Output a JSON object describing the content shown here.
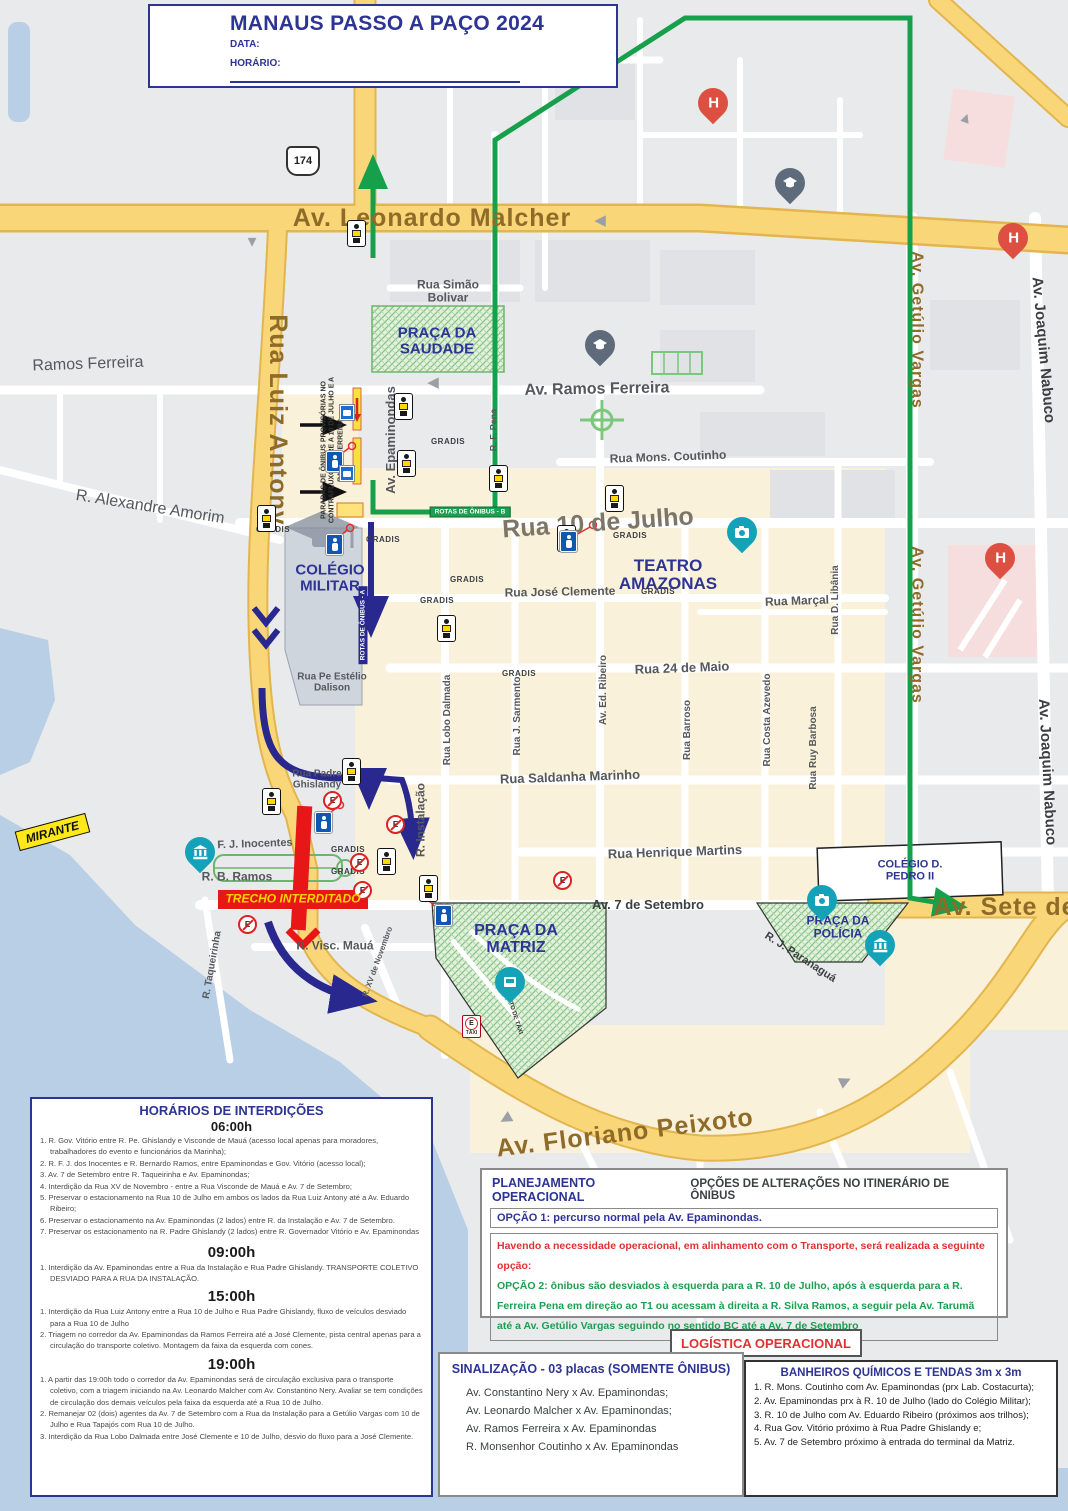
{
  "title_box": {
    "title": "MANAUS PASSO A PAÇO 2024",
    "data_label": "DATA:",
    "horario_label": "HORÁRIO:"
  },
  "map": {
    "labels": {
      "leonardo_malcher": "Av. Leonardo Malcher",
      "simao_bolivar": "Rua Simão Bolivar",
      "praca_saudade": "PRAÇA DA SAUDADE",
      "ramos_ferreira_left": "Ramos Ferreira",
      "av_ramos_ferreira": "Av. Ramos Ferreira",
      "mons_coutinho": "Rua Mons. Coutinho",
      "alexandre_amorim": "R. Alexandre Amorim",
      "rua_luiz_antony": "Rua Luiz Antony",
      "av_epaminondas": "Av. Epaminondas",
      "rua_10_julho": "Rua 10 de Julho",
      "teatro_amazonas": "TEATRO AMAZONAS",
      "jose_clemente": "Rua José Clemente",
      "rua_marcal": "Rua Marçal",
      "rua_d_libania": "Rua D. Libânia",
      "getulio_vargas": "Av. Getúlio Vargas",
      "joaquim_nabuco": "Av. Joaquim Nabuco",
      "rua_24_maio": "Rua 24 de Maio",
      "av_ed_ribeiro": "Av. Ed. Ribeiro",
      "rua_j_sarmento": "Rua J. Sarmento",
      "rua_lobo_dalmada": "Rua Lobo Dalmada",
      "rua_barroso": "Rua Barroso",
      "rua_costa_azevedo": "Rua Costa Azevedo",
      "rua_ruy_barbosa": "Rua Ruy Barbosa",
      "saldanha_marinho": "Rua Saldanha Marinho",
      "pe_estelio": "Rua Pe Estélio Dalison",
      "padre_ghislandy": "Rua Padre Ghislandy",
      "r_instalacao": "R. Instalação",
      "r_f_pena": "R. F. Pena",
      "rf_j_inocentes": "R. F. J. Inocentes",
      "r_b_ramos": "R. B. Ramos",
      "trecho_interditado": "TRECHO INTERDITADO",
      "r_visc_maua": "R. Visc. Mauá",
      "r_taqueirinha": "R. Taqueirinha",
      "r_xv_novembro": "R. XV de Novembro",
      "henrique_martins": "Rua Henrique Martins",
      "av_7_setembro": "Av. 7 de Setembro",
      "colegio_pedro": "COLÉGIO D. PEDRO II",
      "praca_matriz": "PRAÇA DA MATRIZ",
      "praca_policia": "PRAÇA DA POLÍCIA",
      "r_j_paranagua": "R. J. Paranaguá",
      "av_sete_de": "Av. Sete de",
      "floriano_peixoto": "Av. Floriano Peixoto",
      "mirante": "MIRANTE",
      "colegio_militar": "COLÉGIO MILITAR",
      "shield": "174",
      "gradis": "GRADIS",
      "rotas_onibus_a": "ROTAS DE ÔNIBUS - A",
      "rotas_onibus_b": "ROTAS DE ÔNIBUS - B",
      "paradas_note": "PARADAS DE ÔNIBUS PROVISÓRIAS NO CONTRAFLUXO ENTRE A 10 DE JULHO E A RAMOS FERREIRA",
      "ponto_taxi": "PONTO DE TÁXI",
      "e_letter": "E",
      "taxi": "TÁXI",
      "h_letter": "H"
    }
  },
  "horarios": {
    "title": "HORÁRIOS DE INTERDIÇÕES",
    "sections": [
      {
        "time": "06:00h",
        "items": [
          "1. R. Gov. Vitório entre R. Pe. Ghislandy e Visconde de Mauá (acesso local apenas para moradores, trabalhadores do evento e funcionários da Marinha);",
          "2. R. F. J. dos Inocentes e R. Bernardo Ramos, entre Epaminondas e Gov. Vitório (acesso local);",
          "3. Av. 7 de Setembro entre R. Taqueirinha e Av. Epaminondas;",
          "4. Interdição da Rua XV de Novembro - entre a Rua Visconde de Mauá e Av. 7 de Setembro;",
          "5. Preservar o estacionamento na Rua 10 de Julho em ambos os lados da Rua Luiz Antony até a Av. Eduardo Ribeiro;",
          "6. Preservar o estacionamento na Av. Epaminondas (2 lados) entre R. da Instalação e Av. 7 de Setembro.",
          "7. Preservar os estacionamento na R. Padre Ghislandy (2 lados) entre R. Governador Vitório e Av. Epaminondas"
        ]
      },
      {
        "time": "09:00h",
        "items": [
          "1. Interdição da Av. Epaminondas entre a Rua da Instalação e Rua Padre Ghislandy. TRANSPORTE COLETIVO DESVIADO PARA A RUA DA INSTALAÇÃO."
        ]
      },
      {
        "time": "15:00h",
        "items": [
          "1. Interdição da Rua Luiz Antony entre a Rua 10 de Julho e Rua Padre Ghislandy, fluxo de veículos desviado para a Rua 10 de Julho",
          "2. Triagem no corredor da Av. Epaminondas da Ramos Ferreira até a José Clemente, pista central apenas para a circulação do transporte coletivo. Montagem da faixa da esquerda com cones."
        ]
      },
      {
        "time": "19:00h",
        "items": [
          "1. A partir das 19:00h todo o corredor da Av. Epaminondas será de circulação exclusiva para o transporte coletivo, com a triagem iniciando na Av. Leonardo Malcher com Av. Constantino Nery. Avaliar se tem condições de circulação dos demais veículos pela faixa da esquerda até a Rua 10 de Julho.",
          "2. Remanejar 02 (dois) agentes da Av. 7 de Setembro com a Rua da Instalação para a Getúlio Vargas com 10 de Julho e Rua Tapajós com Rua 10 de Julho.",
          "3. Interdição da Rua Lobo Dalmada entre José Clemente e 10 de Julho, desvio do fluxo para a José Clemente."
        ]
      }
    ]
  },
  "planejamento": {
    "header_left": "PLANEJAMENTO OPERACIONAL",
    "header_right": "OPÇÕES DE ALTERAÇÕES NO ITINERÁRIO DE ÔNIBUS",
    "opcao1": "OPÇÃO 1: percurso normal pela Av. Epaminondas.",
    "aviso": "Havendo a necessidade operacional, em alinhamento com o Transporte, será realizada a seguinte opção:",
    "opcao2": "OPÇÃO 2: ônibus são desviados à esquerda para a R. 10 de Julho, após à esquerda para a R. Ferreira Pena em direção ao T1 ou acessam à direita a R. Silva Ramos, a seguir pela Av. Tarumã até a Av. Getúlio Vargas seguindo no sentido BC até a Av. 7 de Setembro"
  },
  "logistica": {
    "title": "LOGÍSTICA OPERACIONAL"
  },
  "sinalizacao": {
    "title": "SINALIZAÇÃO - 03 placas (SOMENTE ÔNIBUS)",
    "items": [
      "Av. Constantino Nery x Av. Epaminondas;",
      "Av. Leonardo Malcher x Av. Epaminondas;",
      "Av. Ramos Ferreira x Av. Epaminondas",
      "R. Monsenhor Coutinho x Av. Epaminondas"
    ]
  },
  "banheiros": {
    "title": "BANHEIROS QUÍMICOS E TENDAS 3m x 3m",
    "items": [
      "1. R. Mons. Coutinho com Av. Epaminondas (prx Lab. Costacurta);",
      "2. Av. Epaminondas prx à R. 10 de Julho (lado do Colégio Militar);",
      "3. R. 10 de Julho com Av. Eduardo Ribeiro (próximos aos trilhos);",
      "4. Rua Gov. Vitório próximo à Rua Padre Ghislandy e;",
      "5. Av. 7 de Setembro próximo à entrada do terminal da Matriz."
    ]
  }
}
